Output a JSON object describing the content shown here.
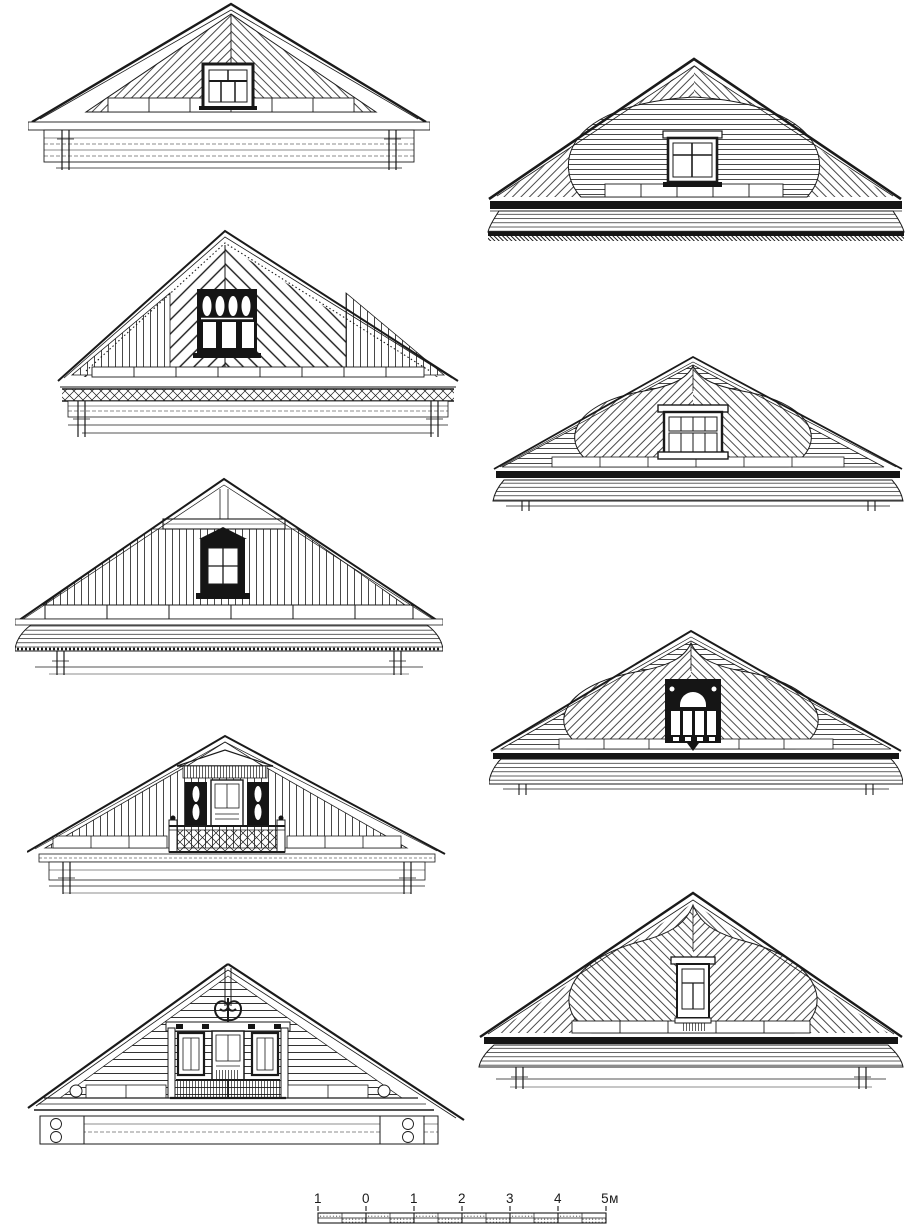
{
  "page": {
    "background": "#ffffff",
    "ink": "#1a1a1a"
  },
  "figures": [
    {
      "name": "gable-hip-roof-diagonal-boarding-six-pane-window"
    },
    {
      "name": "gable-rounded-panel-horizontal-boarding-cross-window"
    },
    {
      "name": "gable-chevron-herringbone-boarding-carved-window"
    },
    {
      "name": "gable-ogee-kokoshnik-panel-eight-pane-window"
    },
    {
      "name": "gable-vertical-boarding-carved-nalichnik-window"
    },
    {
      "name": "gable-ogee-kokoshnik-panel-arched-carved-window"
    },
    {
      "name": "gable-vertical-boarding-balcony-lattice-railing"
    },
    {
      "name": "gable-log-wall-balcony-scroll-finial"
    },
    {
      "name": "gable-ogee-keel-panel-tall-window"
    }
  ],
  "scalebar": {
    "labels": [
      "1",
      "0",
      "1",
      "2",
      "3",
      "4",
      "5м"
    ]
  }
}
